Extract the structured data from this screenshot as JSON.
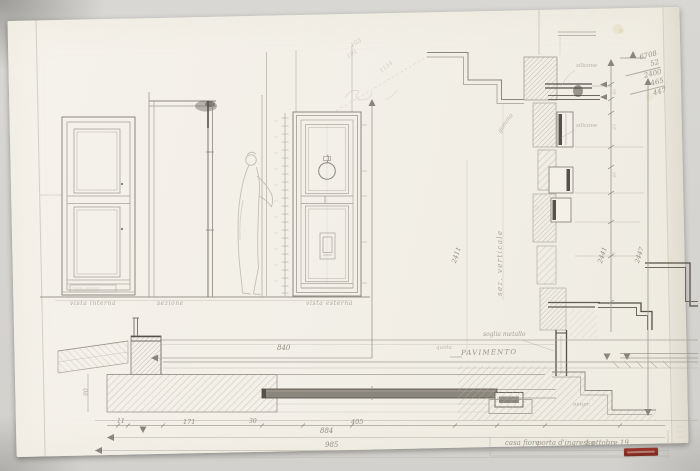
{
  "sheet": {
    "background": "#d6d5d1",
    "paper": "#f3f0e9",
    "pencil": "#a9a49a",
    "pencil_dark": "#55514a",
    "stamp_red": "#8c2f24"
  },
  "view_labels": {
    "left": "vista interna",
    "center": "sezione",
    "right": "vista esterna"
  },
  "notes": {
    "soglia": "soglia metallo",
    "quota": "quota",
    "pavimento": "PAVIMENTO",
    "verticale": "sez. verticale",
    "gomma": "gomma",
    "silicone_a": "silicone",
    "silicone_b": "silicone",
    "neoprene": "neopr."
  },
  "dims": {
    "w840": "840",
    "w884": "884",
    "w985": "985",
    "w405": "405",
    "w171": "171",
    "w11": "11",
    "w30": "30",
    "h2411": "2411",
    "h2441": "2441",
    "h2447": "2447",
    "t40": "40",
    "t25": "25",
    "t46": "46",
    "t77": "77",
    "t90": "90"
  },
  "calc": {
    "r1": "6708",
    "r2": "52",
    "r3": "2400",
    "r4": "465",
    "r5": "447"
  },
  "annotations": {
    "a1": "103",
    "a2": "101",
    "a3": "1154"
  },
  "caption": {
    "project": "casa fiore",
    "subject": "porta d'ingresso",
    "date": "1 ottobre 19.."
  }
}
